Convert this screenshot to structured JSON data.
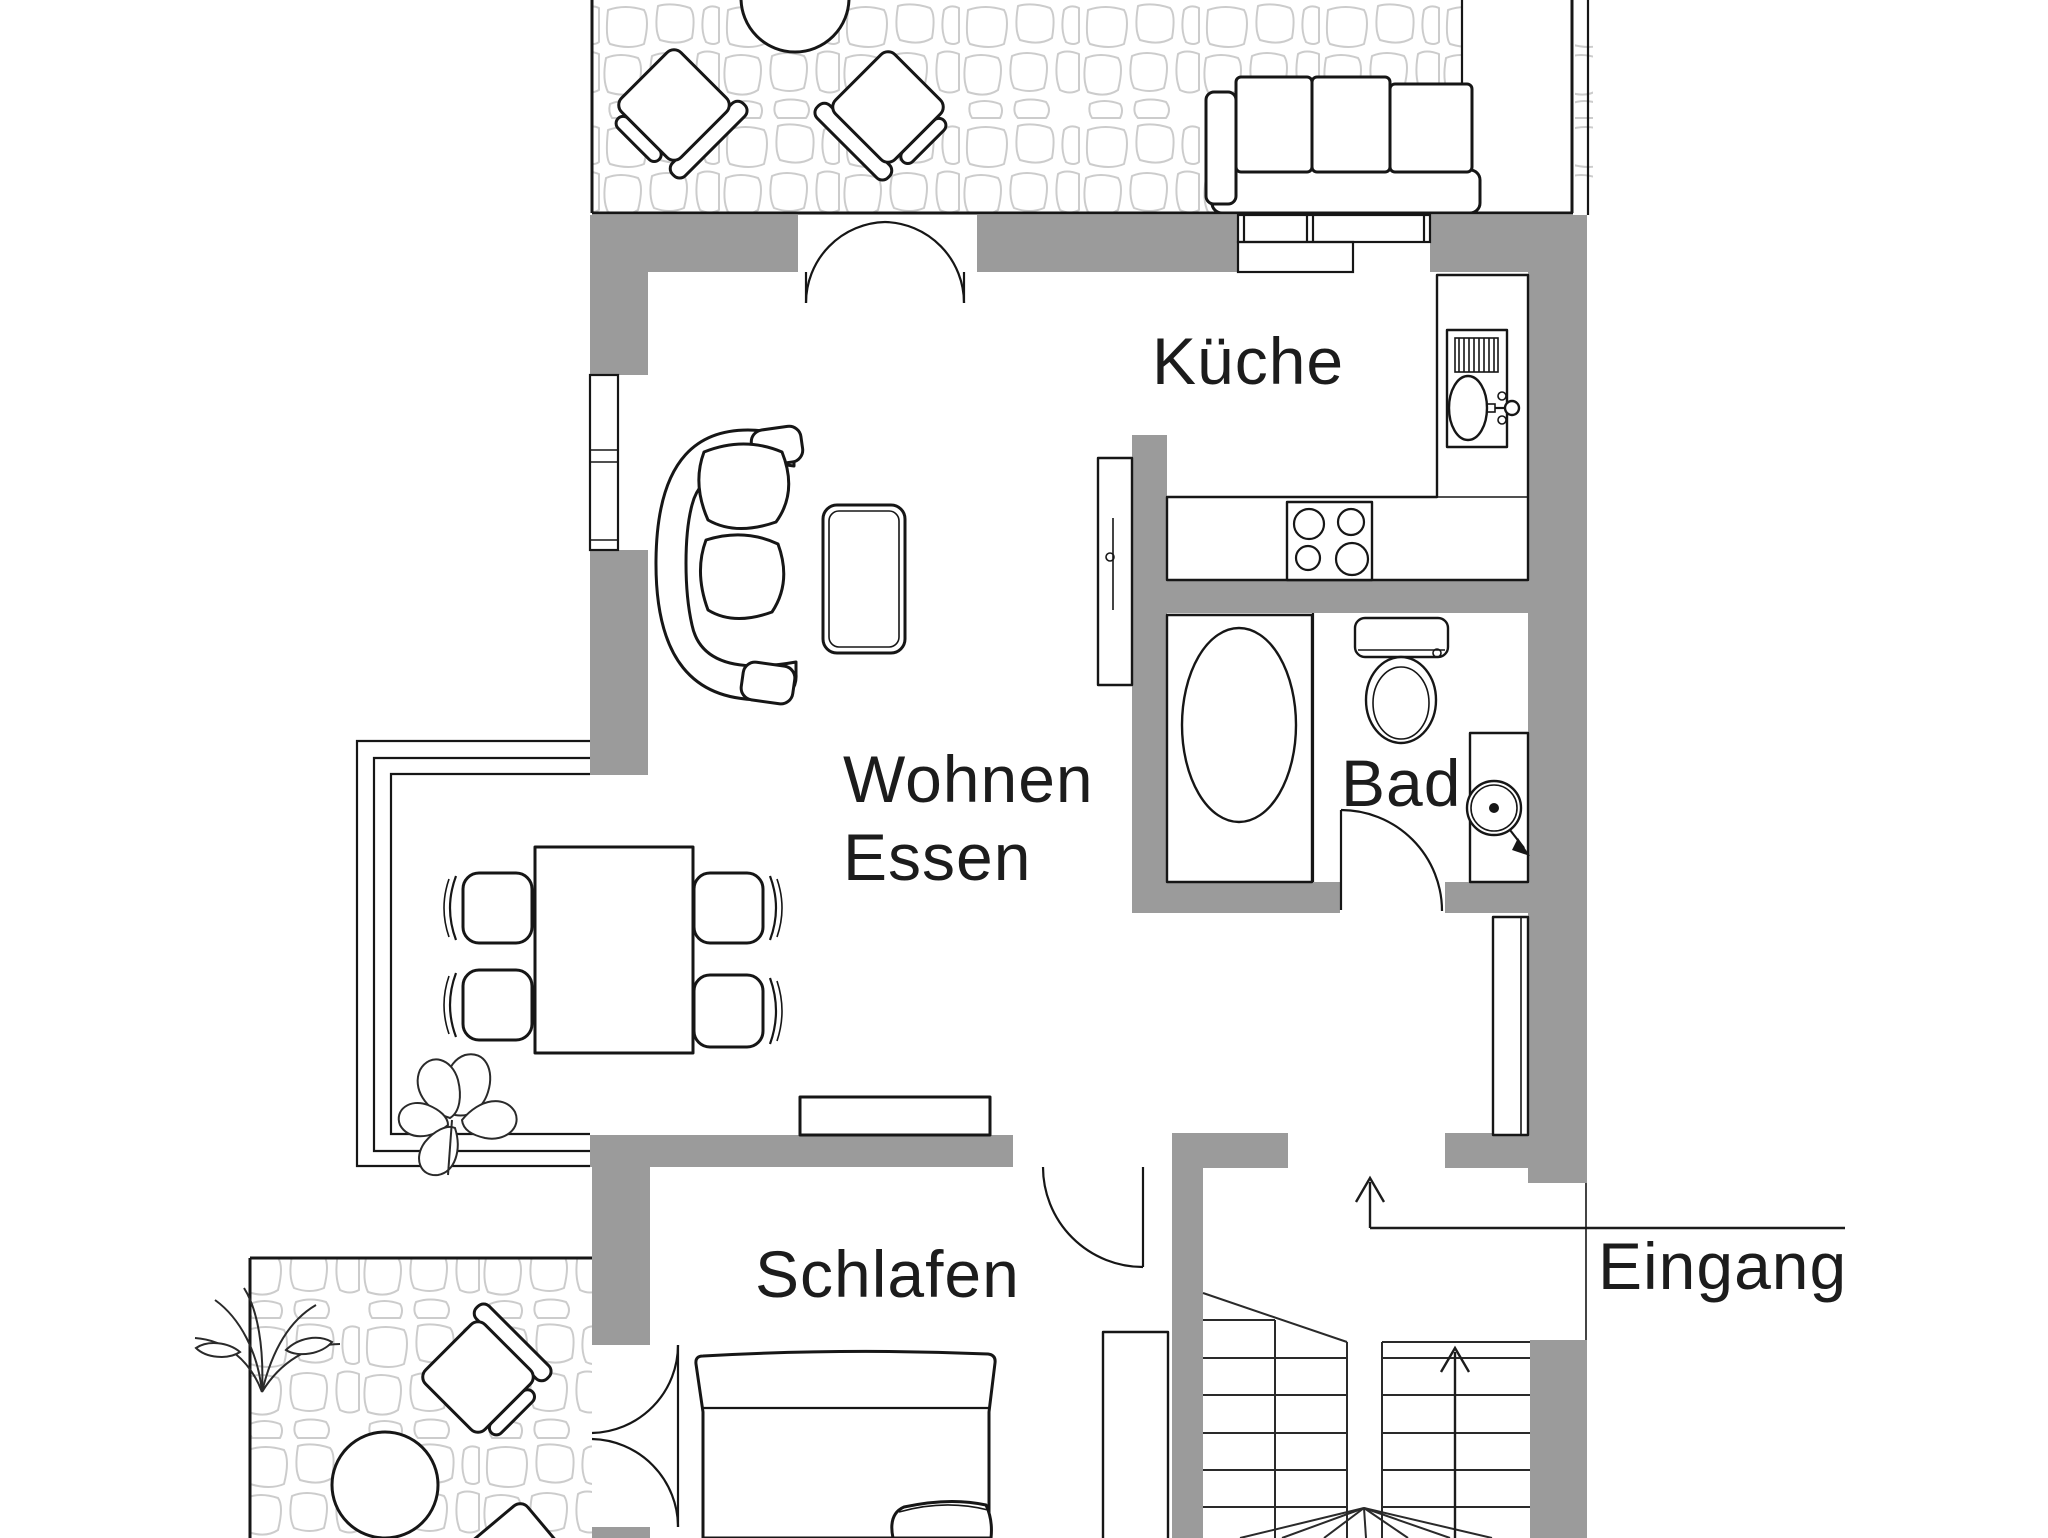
{
  "document": {
    "kind": "apartment-floor-plan"
  },
  "labels": {
    "kitchen": "Küche",
    "living": "Wohnen",
    "dining": "Essen",
    "bathroom": "Bad",
    "bedroom": "Schlafen",
    "entrance": "Eingang"
  },
  "colors": {
    "wall_fill": "#9b9b9b",
    "line": "#161616",
    "stone_outline": "#cccccc",
    "background": "#ffffff",
    "text": "#1c1c1c"
  }
}
